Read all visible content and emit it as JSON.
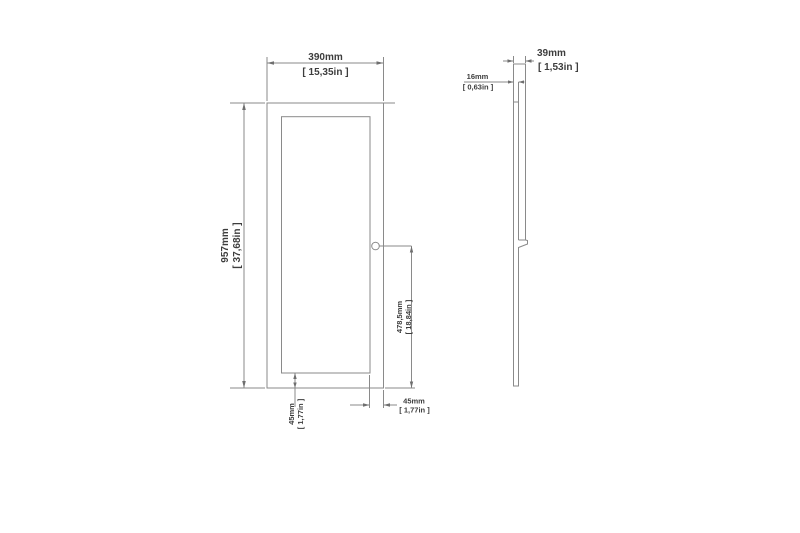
{
  "drawing": {
    "type": "technical-dimension-drawing",
    "views": {
      "front": {
        "name": "front-view"
      },
      "side": {
        "name": "side-view"
      }
    },
    "colors": {
      "background": "#ffffff",
      "line": "#8a8a8a",
      "text": "#3d3d3d"
    },
    "dimensions": {
      "overall_width": {
        "mm": "390mm",
        "inch": "[ 15,35in ]"
      },
      "overall_height": {
        "mm": "957mm",
        "inch": "[ 37,68in ]"
      },
      "handle_height": {
        "mm": "478,5mm",
        "inch": "[ 18,84in ]"
      },
      "bottom_rail": {
        "mm": "45mm",
        "inch": "[ 1,77in ]"
      },
      "right_stile": {
        "mm": "45mm",
        "inch": "[ 1,77in ]"
      },
      "overall_depth": {
        "mm": "39mm",
        "inch": "[ 1,53in ]"
      },
      "panel_thickness": {
        "mm": "16mm",
        "inch": "[ 0,63in ]"
      }
    }
  }
}
